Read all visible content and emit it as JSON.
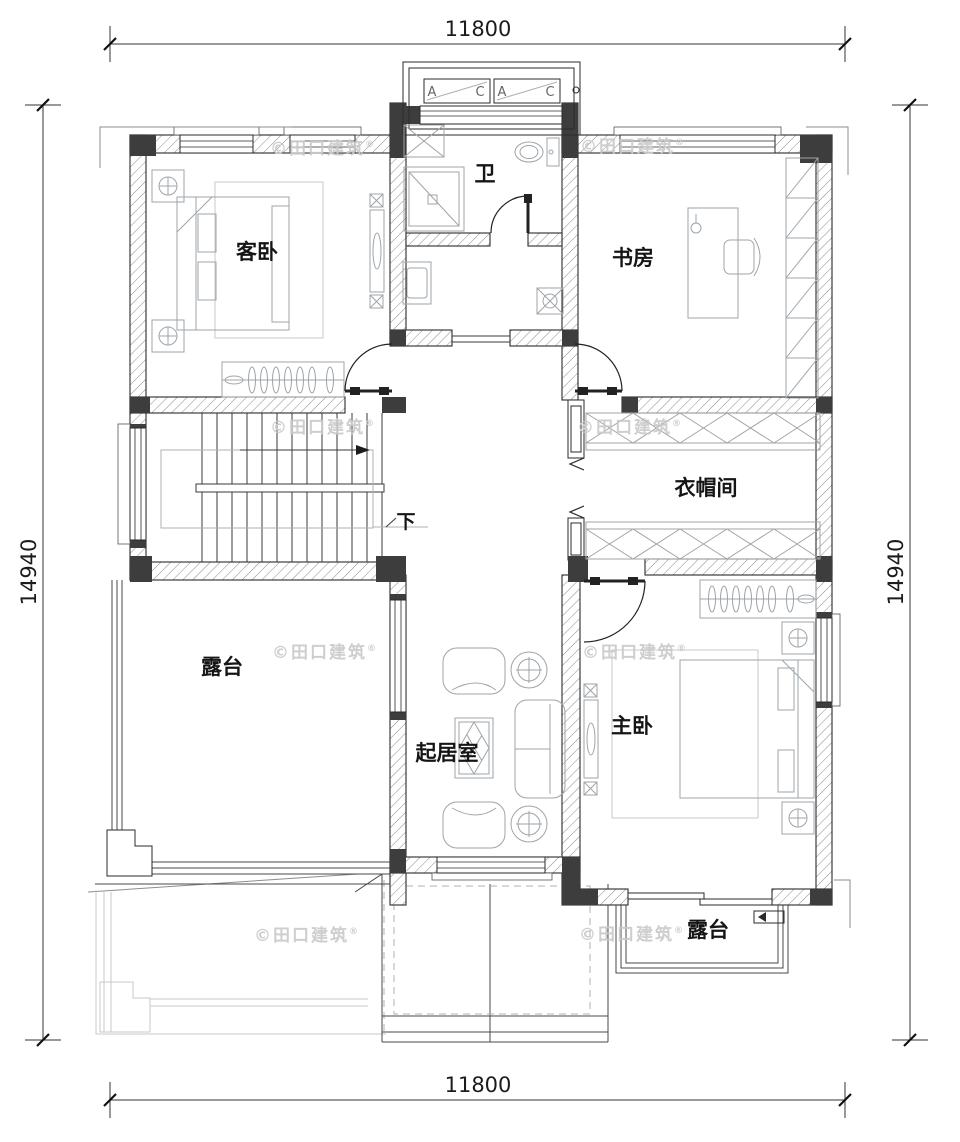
{
  "dimensions": {
    "top": "11800",
    "bottom": "11800",
    "left": "14940",
    "right": "14940"
  },
  "rooms": {
    "guest_bedroom": "客卧",
    "bathroom": "卫",
    "study": "书房",
    "cloakroom": "衣帽间",
    "terrace_left": "露台",
    "living_room": "起居室",
    "master_bedroom": "主卧",
    "terrace_bottom": "露台"
  },
  "stairs": {
    "down_label": "下"
  },
  "bay_window": {
    "labels": [
      "A",
      "C",
      "A",
      "C"
    ]
  },
  "watermark": {
    "text": "©田口建筑",
    "reg": "®"
  },
  "colors": {
    "line": "#2b2b2b",
    "column_fill": "#3d3d3d",
    "furniture_line": "#9fa4a8",
    "light_line": "#c6c9cc",
    "watermark": "#c9c9c9",
    "paper": "#ffffff"
  }
}
